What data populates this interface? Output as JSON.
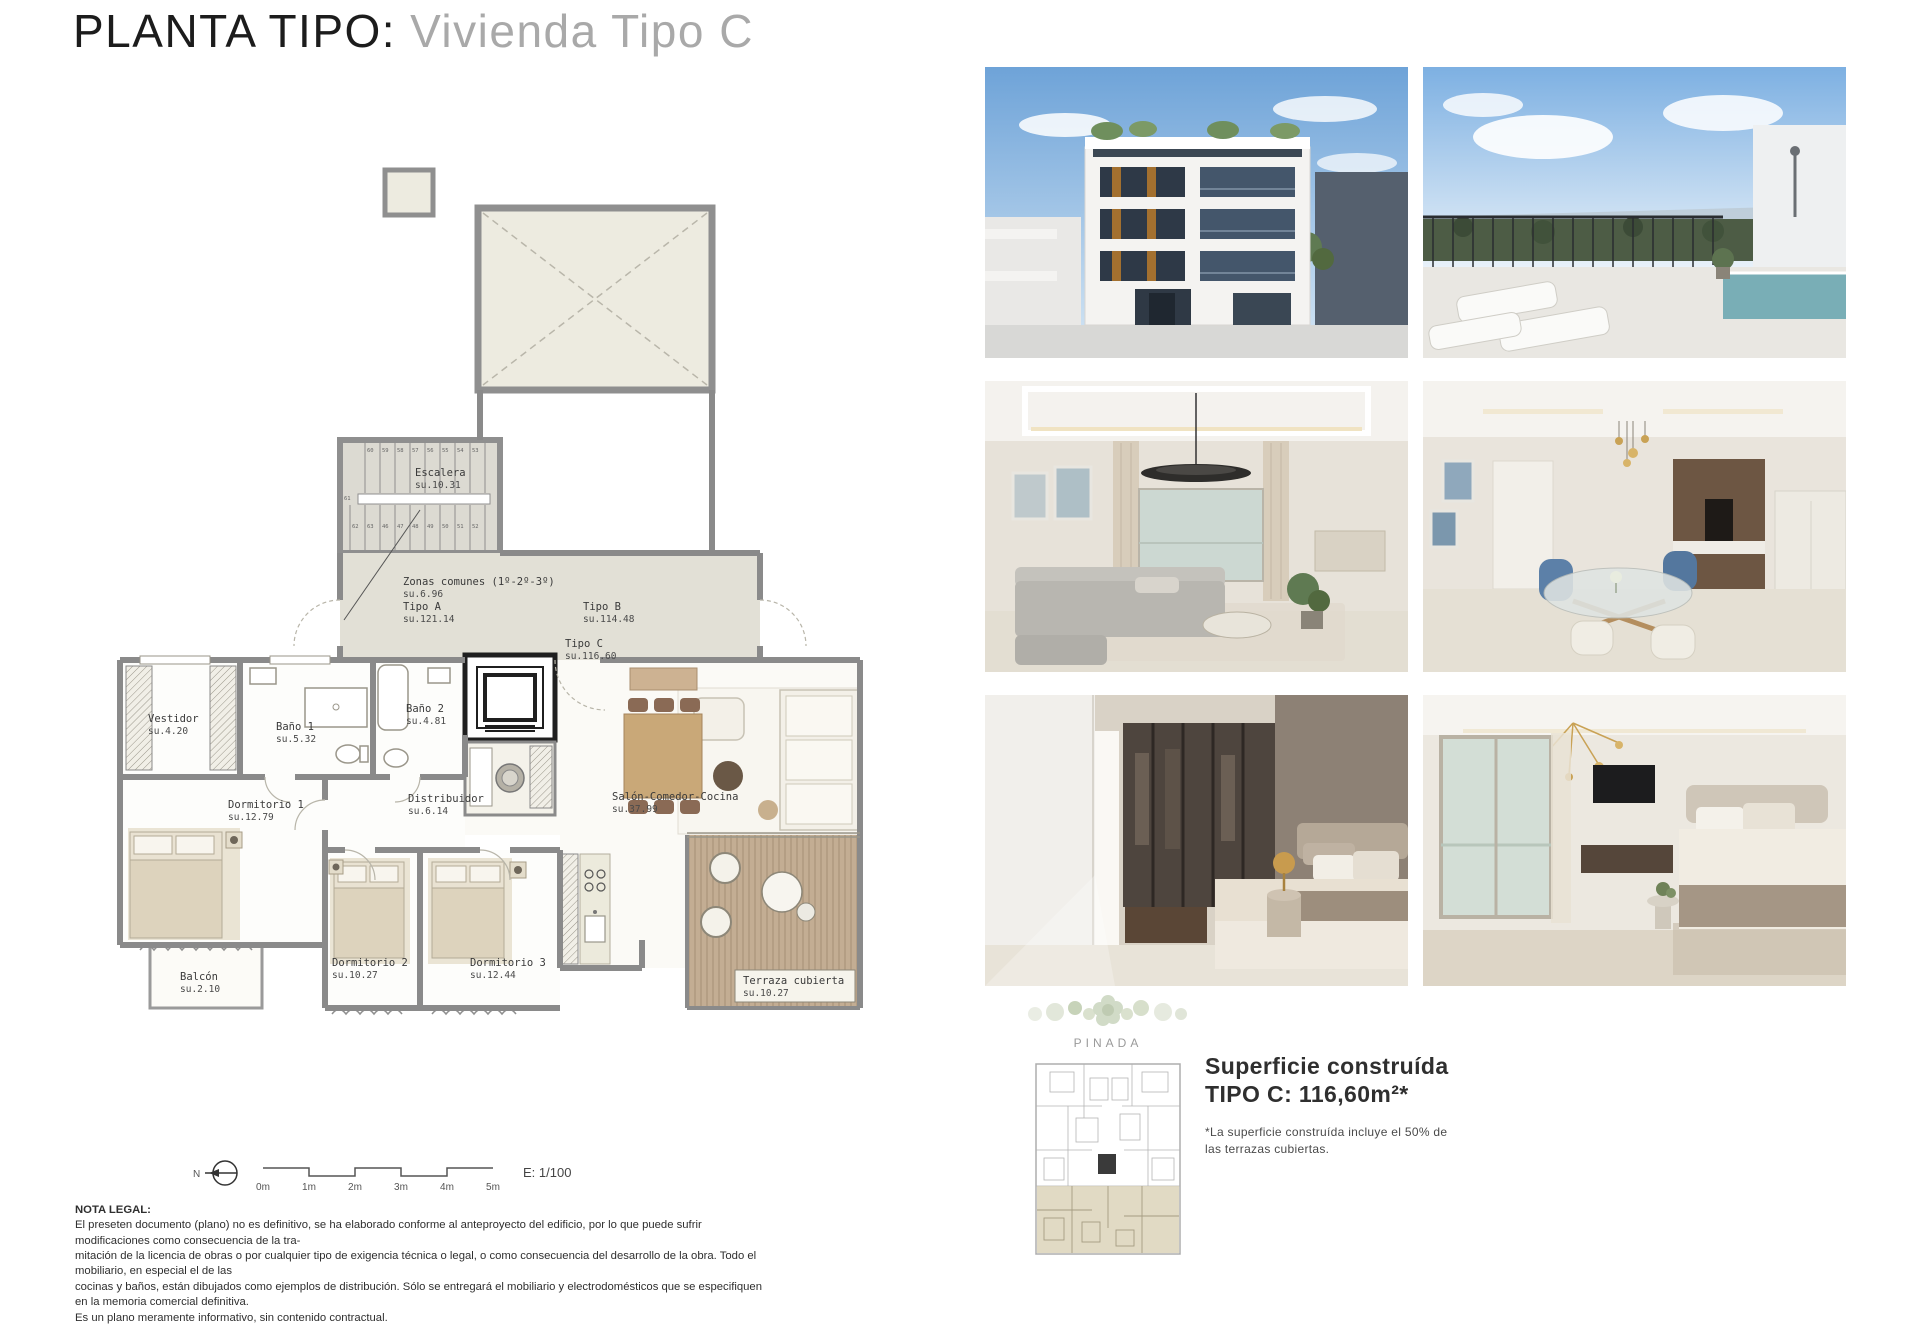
{
  "title": {
    "black": "PLANTA TIPO:",
    "gray": "Vivienda Tipo C"
  },
  "floorplan": {
    "rooms": [
      {
        "id": "escalera",
        "name": "Escalera",
        "su": "su.10.31",
        "x": 335,
        "y": 316
      },
      {
        "id": "zonas-comunes",
        "name": "Zonas comunes (1º-2º-3º)",
        "su": "su.6.96",
        "x": 323,
        "y": 425
      },
      {
        "id": "tipo-a",
        "name": "Tipo A",
        "su": "su.121.14",
        "x": 323,
        "y": 450
      },
      {
        "id": "tipo-b",
        "name": "Tipo B",
        "su": "su.114.48",
        "x": 503,
        "y": 450
      },
      {
        "id": "tipo-c",
        "name": "Tipo C",
        "su": "su.116.60",
        "x": 485,
        "y": 487
      },
      {
        "id": "vestidor",
        "name": "Vestidor",
        "su": "su.4.20",
        "x": 68,
        "y": 562
      },
      {
        "id": "bano-1",
        "name": "Baño 1",
        "su": "su.5.32",
        "x": 196,
        "y": 570
      },
      {
        "id": "bano-2",
        "name": "Baño 2",
        "su": "su.4.81",
        "x": 326,
        "y": 552
      },
      {
        "id": "dormitorio-1",
        "name": "Dormitorio 1",
        "su": "su.12.79",
        "x": 148,
        "y": 648
      },
      {
        "id": "distribuidor",
        "name": "Distribuidor",
        "su": "su.6.14",
        "x": 328,
        "y": 642
      },
      {
        "id": "salon",
        "name": "Salón-Comedor-Cocina",
        "su": "su.37.99",
        "x": 532,
        "y": 640
      },
      {
        "id": "dormitorio-2",
        "name": "Dormitorio 2",
        "su": "su.10.27",
        "x": 252,
        "y": 806
      },
      {
        "id": "dormitorio-3",
        "name": "Dormitorio 3",
        "su": "su.12.44",
        "x": 390,
        "y": 806
      },
      {
        "id": "balcon",
        "name": "Balcón",
        "su": "su.2.10",
        "x": 100,
        "y": 820
      },
      {
        "id": "terraza",
        "name": "Terraza cubierta",
        "su": "su.10.27",
        "x": 663,
        "y": 824
      }
    ],
    "stairs": {
      "top": [
        "60",
        "59",
        "58",
        "57",
        "56",
        "55",
        "54",
        "53"
      ],
      "bottom": [
        "62",
        "63",
        "46",
        "47",
        "48",
        "49",
        "50",
        "51",
        "52"
      ],
      "mid": "61"
    }
  },
  "scalebar": {
    "north": "N",
    "labels": [
      "0m",
      "1m",
      "2m",
      "3m",
      "4m",
      "5m"
    ],
    "scale": "E: 1/100"
  },
  "surface": {
    "line1": "Superficie construída",
    "line2": "TIPO C: 116,60m²*",
    "note1": "*La superficie construída incluye el 50% de",
    "note2": "las terrazas cubiertas."
  },
  "brand": {
    "name": "PINADA"
  },
  "legal": {
    "heading": "NOTA LEGAL:",
    "lines": [
      "El preseten documento (plano) no es definitivo, se ha elaborado conforme al anteproyecto del edificio, por lo que puede sufrir modificaciones como consecuencia de la tra-",
      "mitación de la licencia de obras o por cualquier tipo de exigencia técnica o legal, o como consecuencia del desarrollo de la obra. Todo el mobiliario, en especial el de las",
      "cocinas y baños, están dibujados como ejemplos de distribución. Sólo se entregará el mobiliario y electrodomésticos que se especifiquen en la memoria comercial definitiva.",
      "Es un plano meramente informativo, sin contenido contractual."
    ]
  },
  "photos": [
    "building-facade",
    "rooftop-terrace",
    "living-room",
    "dining-room",
    "master-bedroom",
    "bedroom-with-view"
  ],
  "colors": {
    "wall": "#8a8a8a",
    "corridor": "#e2e0d6",
    "stair": "#dcdad2",
    "deck": "#c3ad93",
    "beige": "#edebe0"
  }
}
